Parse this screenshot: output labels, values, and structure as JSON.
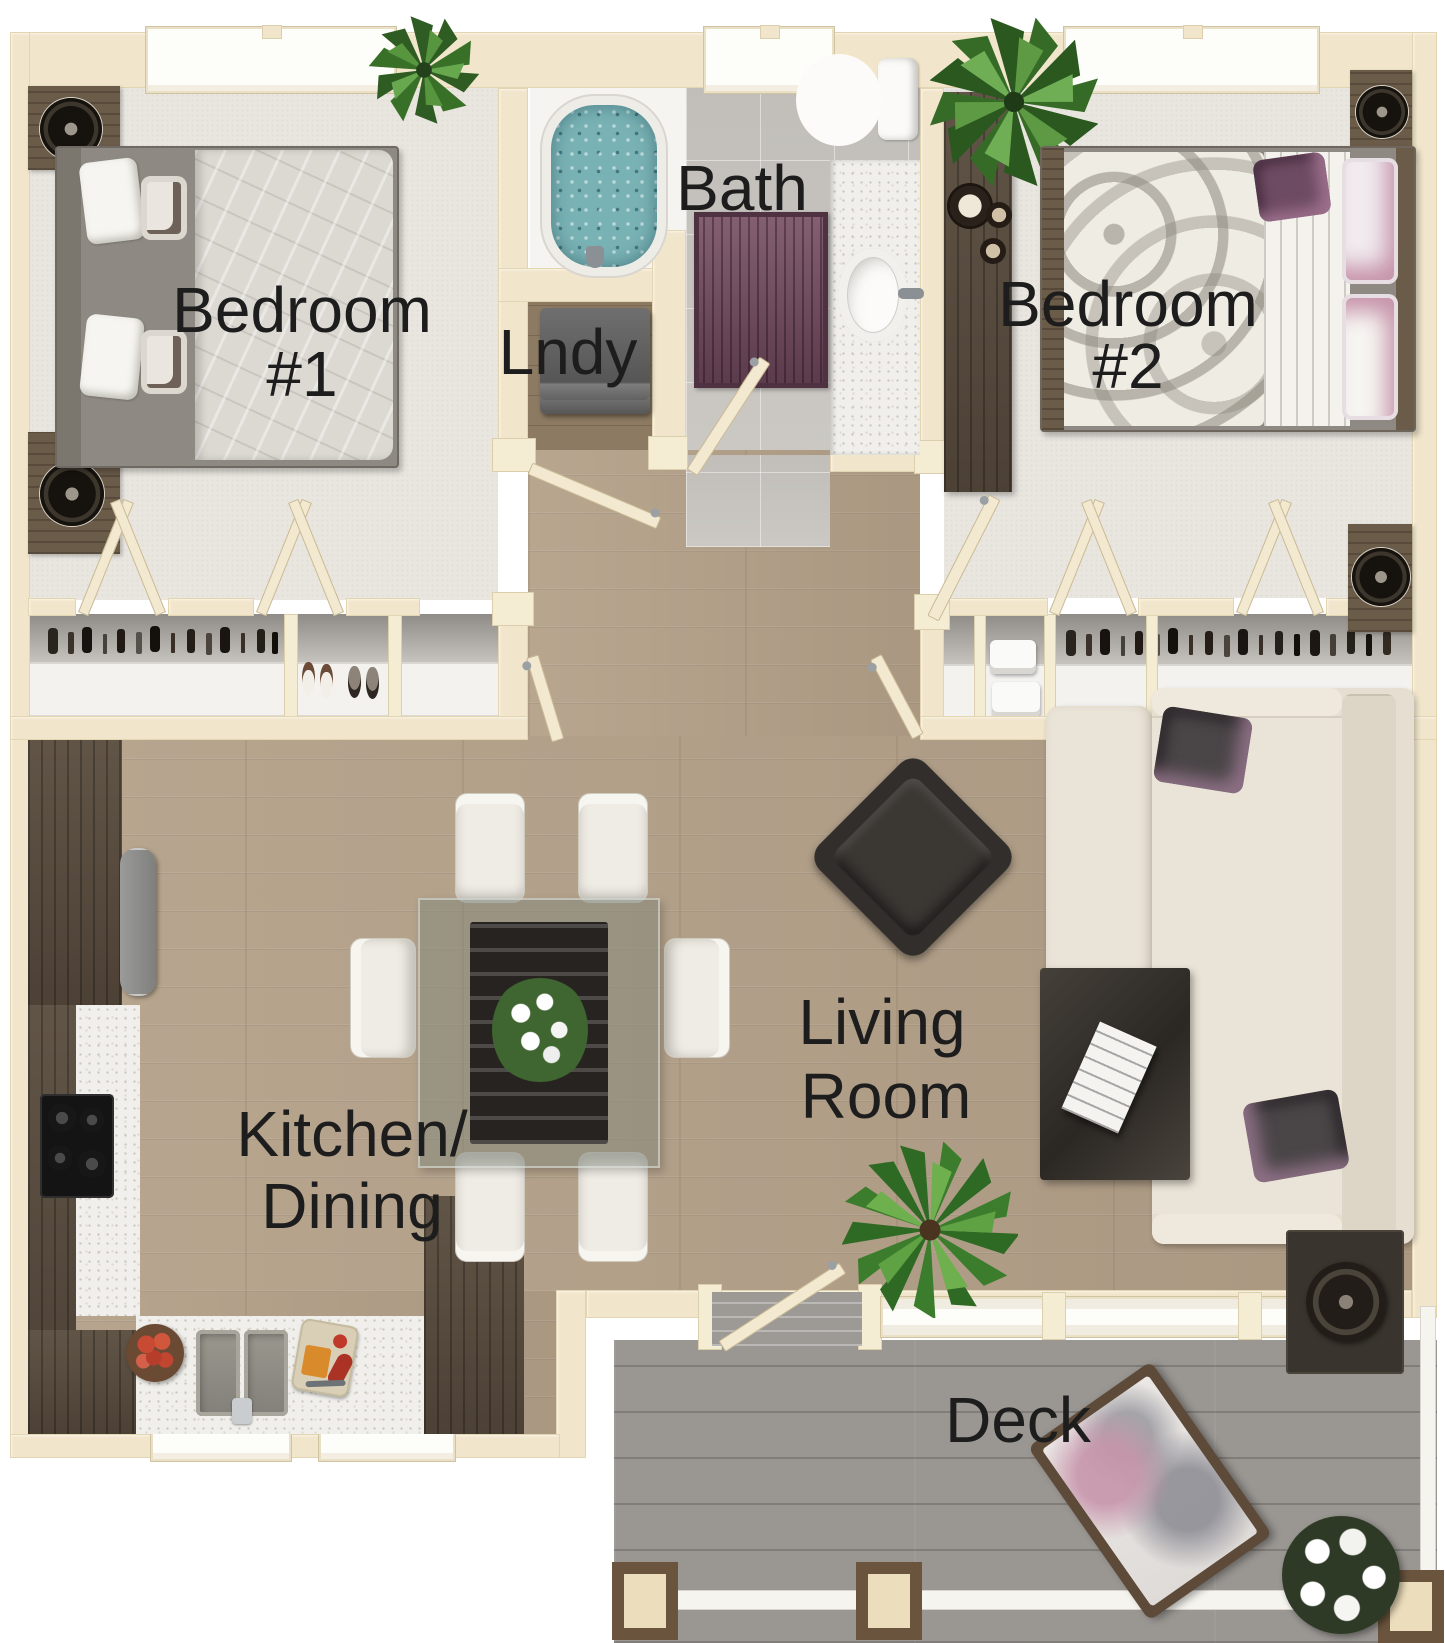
{
  "page": {
    "type": "apartment-floor-plan",
    "background": "#ffffff"
  },
  "rooms": {
    "bedroom1": {
      "line1": "Bedroom",
      "line2": "#1"
    },
    "bedroom2": {
      "line1": "Bedroom",
      "line2": "#2"
    },
    "bath": {
      "label": "Bath"
    },
    "laundry": {
      "label": "Lndy"
    },
    "kitchen_dining": {
      "line1": "Kitchen/",
      "line2": "Dining"
    },
    "living_room": {
      "line1": "Living",
      "line2": "Room"
    },
    "deck": {
      "label": "Deck"
    }
  },
  "colors": {
    "wall": "#f1e6cb",
    "wood_floor": "#b4a189",
    "carpet": "#e9e6e0",
    "bath_tile": "#c9c6c1",
    "deck_wood": "#9a9793",
    "tub_water": "#79b2b5",
    "bath_rug": "#744a60",
    "counter": "#f0efeb",
    "cabinet": "#574a3c",
    "label_text": "#1d1d1d"
  }
}
